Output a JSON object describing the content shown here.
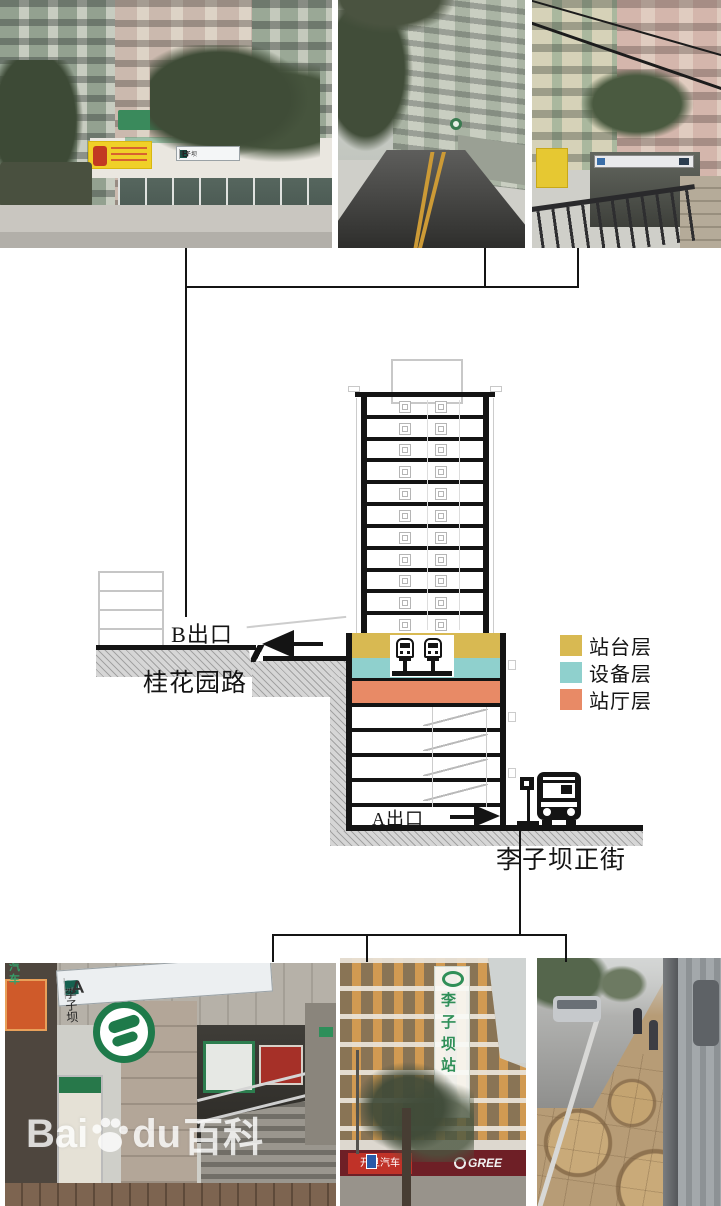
{
  "colors": {
    "platform": "#d8b952",
    "equipment": "#8fd0cd",
    "hall": "#e88a66",
    "diagram-line": "#141414",
    "hatch-bg": "#d6d6d6",
    "hatch-line": "#a2a2a2"
  },
  "diagram": {
    "exit_b_label": "B出口",
    "road_left_label": "桂花园路",
    "exit_a_label": "A出口",
    "road_right_label": "李子坝正街",
    "legend": {
      "items": [
        {
          "label": "站台层",
          "key": "platform"
        },
        {
          "label": "设备层",
          "key": "equipment"
        },
        {
          "label": "站厅层",
          "key": "hall"
        }
      ]
    },
    "tower": {
      "residential_floors": 11,
      "lower_floors": 5
    }
  },
  "photos": {
    "top_left": {
      "station_sign": {
        "line_badge": "2",
        "station": "李子坝",
        "exit": "B"
      }
    },
    "bottom_left": {
      "station_sign": {
        "line_badge": "2",
        "line_suffix": "号线",
        "station": "李子坝",
        "station_en": "Liziba",
        "exit": "A"
      },
      "side_text": "汽车"
    },
    "bottom_middle": {
      "vertical_sign": "李子坝站",
      "shop_sign": "开旦汽车",
      "brand_sign": "GREE"
    }
  },
  "watermark": {
    "prefix": "Bai",
    "mid": "du",
    "suffix": "百科"
  }
}
